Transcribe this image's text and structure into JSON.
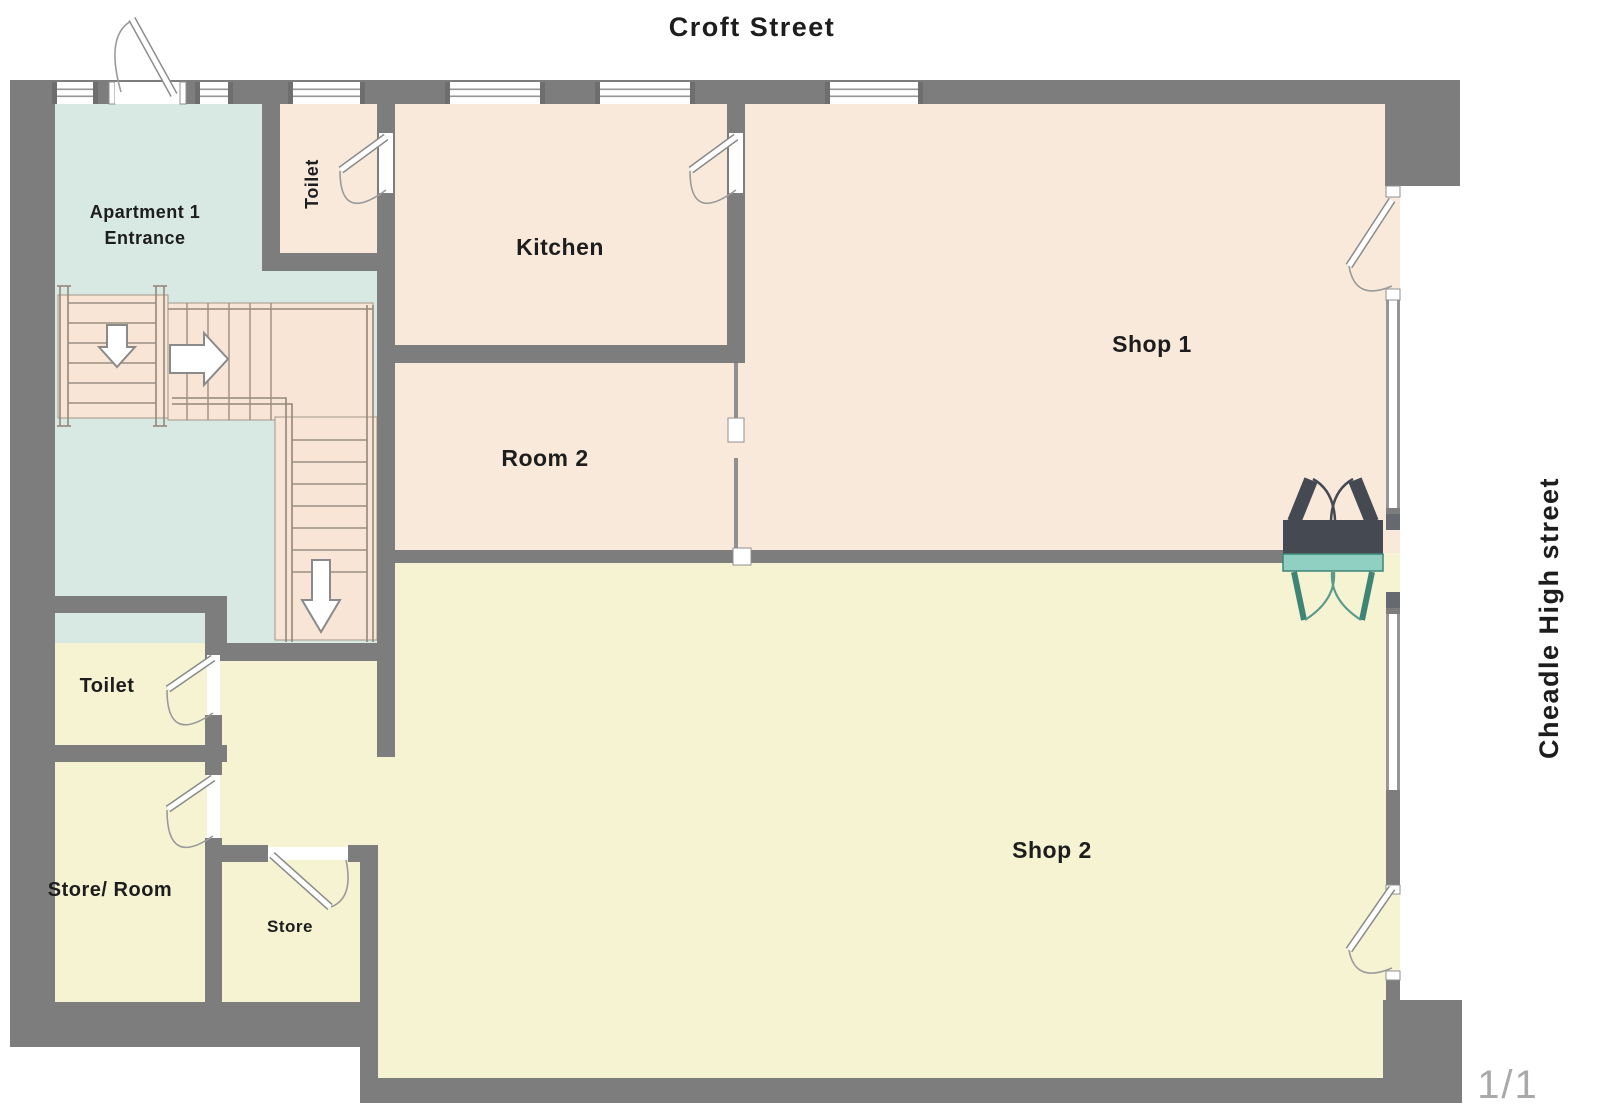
{
  "plan": {
    "street_top": "Croft Street",
    "street_right": "Cheadle High street",
    "page_indicator": "1/1",
    "rooms": {
      "apartment_entrance": {
        "label_line1": "Apartment 1",
        "label_line2": "Entrance"
      },
      "toilet_top": {
        "label": "Toilet"
      },
      "kitchen": {
        "label": "Kitchen"
      },
      "room2": {
        "label": "Room 2"
      },
      "shop1": {
        "label": "Shop 1"
      },
      "shop2": {
        "label": "Shop 2"
      },
      "toilet_left": {
        "label": "Toilet"
      },
      "store_room": {
        "label": "Store/ Room"
      },
      "store": {
        "label": "Store"
      }
    },
    "colors": {
      "wall": "#7d7d7d",
      "room_peach": "#f9e9db",
      "room_blue": "#d8e8e3",
      "room_yellow": "#f6f3d2",
      "stairs": "#f8e5d6",
      "door_dark": "#454a52",
      "door_teal_fill": "#8fd0c2",
      "door_teal_stroke": "#3e8578",
      "label_text": "#1d1d1d",
      "page_indicator_text": "#a9a9a9"
    }
  }
}
